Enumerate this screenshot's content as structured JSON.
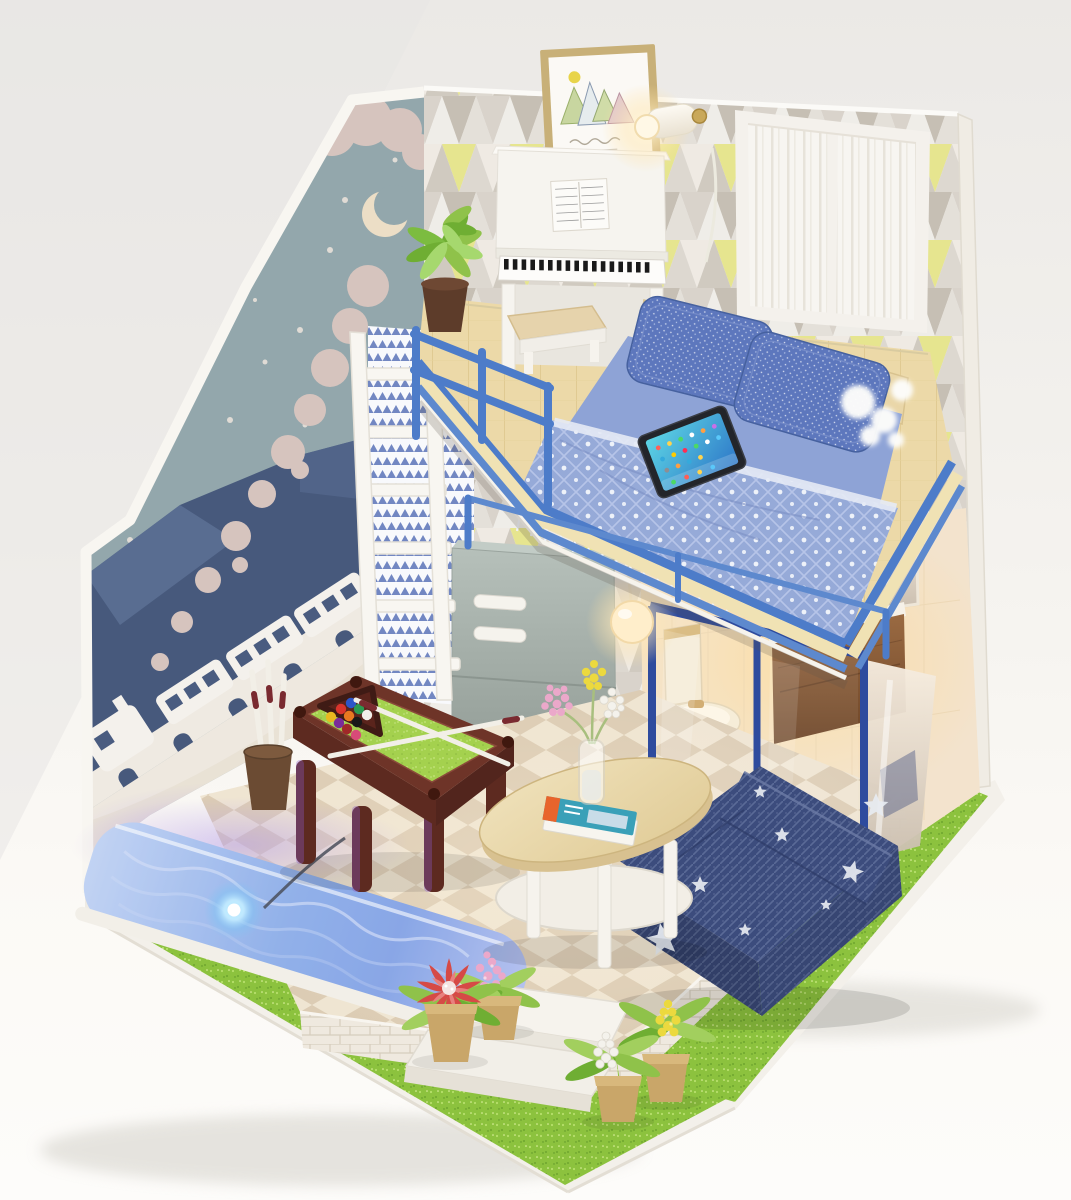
{
  "scene": {
    "type": "photograph",
    "subject": "DIY miniature dollhouse diorama of a two-level loft studio room",
    "backdrop": "white seamless studio background",
    "levels": [
      "loft bedroom with white piano and blue bed",
      "ground floor lounge with pool table, denim sofa and lit plunge pool"
    ]
  },
  "lighting": {
    "wall_lamp": "on",
    "pendant_lamp": "on",
    "nightstand_lamp": "on",
    "pool_led": "on",
    "bathroom_glow": "warm"
  },
  "objects": {
    "left_wall_mural": {
      "label": "winter night train mural",
      "elements": [
        "teal sky",
        "crescent moon",
        "snowflakes",
        "steam smoke trail",
        "dark blue hills",
        "white viaduct",
        "white train silhouette"
      ]
    },
    "back_wall": {
      "label": "geometric triangle wallpaper",
      "accents": [
        "gray",
        "taupe",
        "pale",
        "yellow"
      ]
    },
    "framed_art": {
      "label": "framed triangle-trees print",
      "details": [
        "gold frame",
        "four pastel trees",
        "yellow sun",
        "cursive caption"
      ]
    },
    "wall_lamp": {
      "label": "brass wall lamp with glowing bulb"
    },
    "window": {
      "label": "white framed window with sheer curtains"
    },
    "piano": {
      "label": "white upright piano with sheet music"
    },
    "piano_bench": {
      "label": "white bench with tan seat"
    },
    "loft_plant": {
      "label": "green potted plant"
    },
    "bed": {
      "label": "loft bed with blue knit blanket, fringe and two woven pillows"
    },
    "tablet": {
      "label": "tablet lying on bed",
      "screen": "colorful app grid"
    },
    "railing": {
      "label": "blue loft railing"
    },
    "ladder": {
      "label": "white loft ladder"
    },
    "cabinet": {
      "label": "gray two-door cabinet with white handles"
    },
    "partition": {
      "label": "navy framed glass partition"
    },
    "bathroom": {
      "label": "toilet, wooden nightstand with globe lamp, mirror"
    },
    "pendant_lamp": {
      "label": "glowing globe pendant under loft"
    },
    "pool_table": {
      "label": "maroon pool table with green felt",
      "accessories": [
        "triangle ball rack",
        "two crossed cues"
      ]
    },
    "cue_stand": {
      "label": "pot holding spare cues"
    },
    "pool": {
      "label": "plunge pool with LED light and white rim"
    },
    "sofa": {
      "label": "denim sofa with white stars"
    },
    "coffee_table": {
      "label": "oval wood coffee table",
      "items": [
        "glass vase with berry flowers",
        "magazine"
      ]
    },
    "front_garden": {
      "label": "glitter grass with potted flowers",
      "flowers": [
        "red",
        "pink",
        "white",
        "yellow"
      ]
    },
    "steps": {
      "label": "white entry steps"
    }
  },
  "palette": {
    "backdrop_top": "#ebe9e6",
    "backdrop_mid": "#f4f2ee",
    "backdrop_bottom": "#fcfbf8",
    "base_white": "#f3f0ea",
    "shadow": "#cfccc4",
    "grass": "#8cc23e",
    "grass_light": "#b7df6b",
    "grass_dark": "#6da52e",
    "tile_light": "#efe5d2",
    "tile_dark": "#dcccb4",
    "brick": "#efe9df",
    "brick_line": "#d6cdbd",
    "mural_sky": "#93a7ac",
    "mural_mountain": "#47597c",
    "mural_mountain_light": "#5d7195",
    "mural_cloud": "#d6c4be",
    "mural_snow": "#e9e2da",
    "moon": "#ecdec6",
    "train_body": "#f4f1ec",
    "train_window": "#4a5c80",
    "wallpaper_bg": "#f1efeb",
    "wallpaper_gray": "#d9d3cb",
    "wallpaper_taupe": "#c6bfb4",
    "wallpaper_pale": "#efede8",
    "wallpaper_yellow": "#e6e58f",
    "frame_gold": "#c8b078",
    "art_mat": "#fbf9f5",
    "window_frame": "#f4f1ec",
    "curtain": "#f7f5f1",
    "loft_wood": "#ecd9a8",
    "headboard_wood": "#e9d6a8",
    "railing_blue": "#4d7cc9",
    "railing_blue_light": "#5d89ce",
    "trim_cream": "#f0e2b4",
    "partition_navy": "#2e4b9e",
    "piano_white": "#f6f4ef",
    "key_black": "#1a1a1a",
    "bench_seat": "#e6d3ac",
    "pillow_blue": "#5d77bd",
    "blanket_blue": "#96aad8",
    "tablet_frame": "#23252a",
    "cabinet_gray": "#a5afaa",
    "warm_wall": "#f3e3cd",
    "toilet_cream": "#f5ead2",
    "nightstand_wood": "#8a5c3a",
    "felt_green": "#a4d14e",
    "table_maroon": "#6e3428",
    "cue_white": "#f2efe7",
    "cue_band": "#7a2a30",
    "pool_rim": "#f2efe8",
    "water_blue": "#7fb0e8",
    "led_glow": "#bfeaff",
    "purple_light": "#b79fe8",
    "sofa_denim": "#3c4c7d",
    "star_white": "#e8ecf2",
    "coffee_wood": "#e9d8ac",
    "leg_white": "#f6f3ed",
    "pot_tan": "#c9a669",
    "pot_dark": "#5d3c2a",
    "leaf_green": "#8fc24a",
    "leaf_dark": "#6fae33",
    "flower_red": "#d64a46",
    "flower_pink": "#eba8ca",
    "flower_white": "#f4f2ec",
    "flower_yellow": "#ecd93e",
    "glow_warm": "#ffd98f",
    "billiard_balls": [
      "#e8b820",
      "#d8342c",
      "#2c55c8",
      "#7a2c9a",
      "#e87820",
      "#2c9a50",
      "#a02828",
      "#181818",
      "#f2f0ea",
      "#d84a78"
    ]
  }
}
